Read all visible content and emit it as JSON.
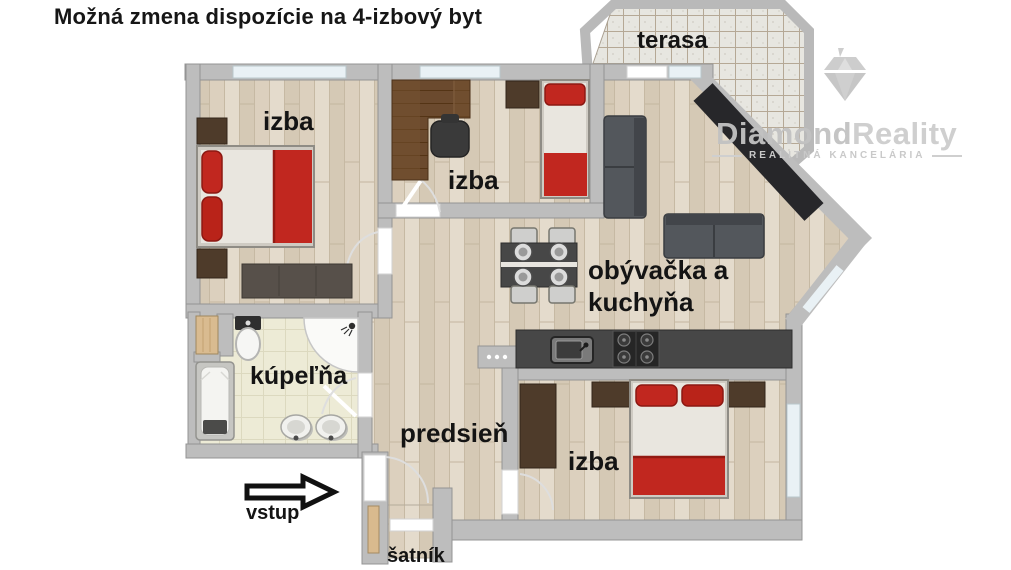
{
  "title": "Možná zmena dispozície na 4-izbový byt",
  "rooms": {
    "terasa": {
      "label": "terasa"
    },
    "izba_top": {
      "label": "izba"
    },
    "izba_middle": {
      "label": "izba"
    },
    "living": {
      "line1": "obývačka a",
      "line2": "kuchyňa"
    },
    "bathroom": {
      "label": "kúpeľňa"
    },
    "hallway": {
      "label": "predsieň"
    },
    "izba_bottom": {
      "label": "izba"
    },
    "closet": {
      "label": "šatník"
    }
  },
  "entrance": {
    "label": "vstup"
  },
  "watermark": {
    "brand1": "Diamond",
    "brand2": "Reality",
    "subtitle": "REALITNÁ KANCELÁRIA"
  },
  "colors": {
    "accent_red": "#c1271f",
    "wall_grey": "#bdbdbd",
    "wood_floor": "#ddd2c0",
    "bath_floor": "#edebd6",
    "counter_dark": "#474747",
    "dark_wood": "#6b4a2e"
  }
}
